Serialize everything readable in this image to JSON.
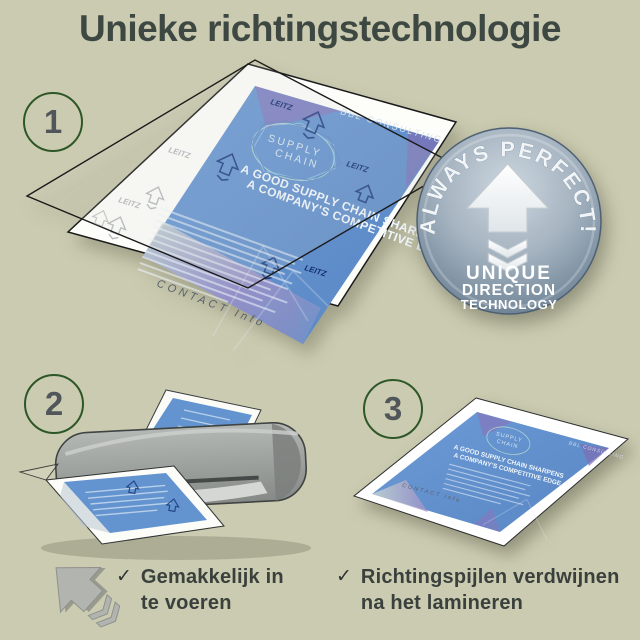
{
  "title": "Unieke richtingstechnologie",
  "steps": {
    "step1": "1",
    "step2": "2",
    "step3": "3"
  },
  "badge": {
    "arc_text": "ALWAYS PERFECT!",
    "line1": "UNIQUE",
    "line2": "DIRECTION",
    "line3": "TECHNOLOGY"
  },
  "brochure": {
    "brand": "BBL CONSULTING",
    "logo": "LEITZ",
    "ring_line1": "SUPPLY",
    "ring_line2": "CHAIN",
    "headline_line1": "A GOOD SUPPLY CHAIN SHARPENS",
    "headline_line2": "A COMPANY'S COMPETITIVE EDGE.",
    "footer": "CONTACT Info"
  },
  "bullets": {
    "item1": {
      "mark": "✓",
      "text": "Gemakkelijk in te voeren"
    },
    "item2": {
      "mark": "✓",
      "text": "Richtingspijlen verdwijnen na het lamineren"
    }
  },
  "colors": {
    "background": "#cbcbb1",
    "title_text": "#3e4843",
    "step_ring_green": "#2e5728",
    "brochure_blue": "#5e90cb",
    "badge_steel": "#8fa1b2",
    "laminator_gray": "#9a9e9b"
  }
}
